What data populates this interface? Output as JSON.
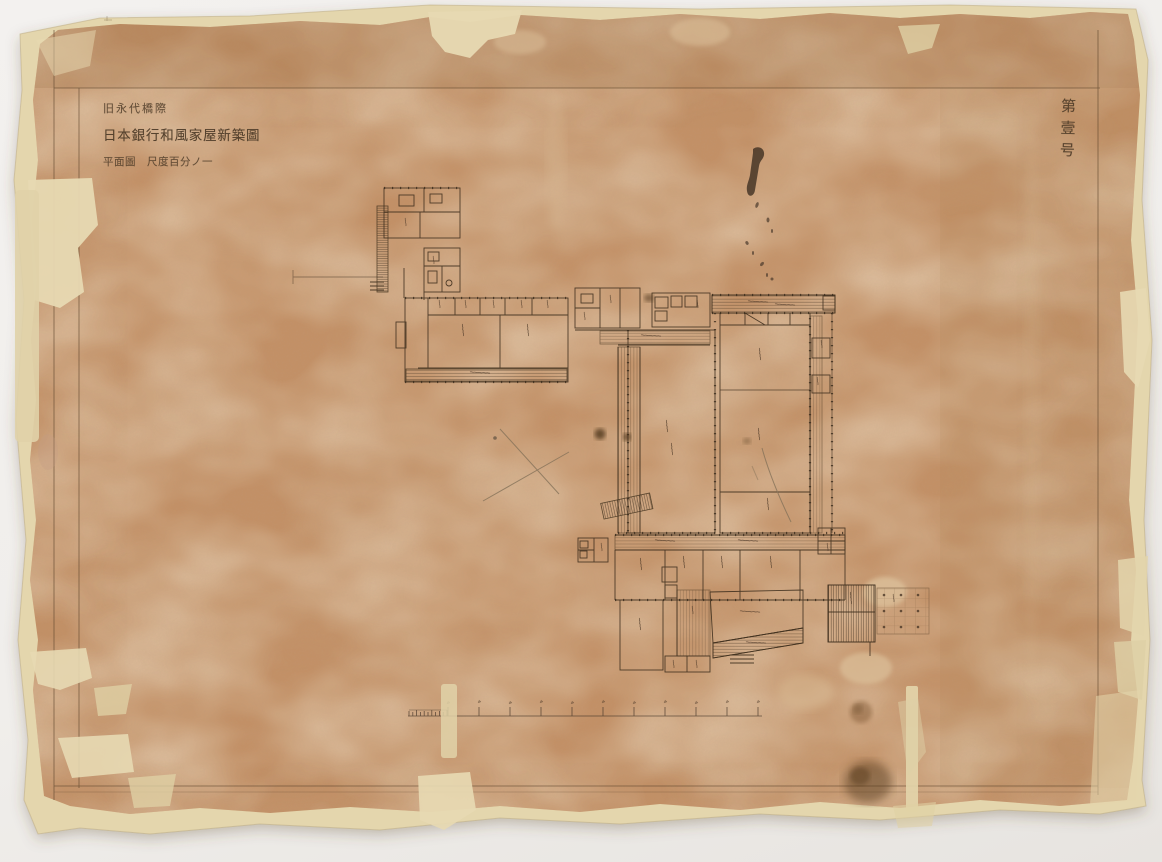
{
  "scene": {
    "backdrop_color": "#f0eeea",
    "paper_color": "#c29066",
    "backing_color": "#e4d6ad",
    "ink_color": "#4a3828",
    "stain_color": "#5a3c1e"
  },
  "title_block": {
    "line1": "旧永代橋際",
    "line2": "日本銀行和風家屋新築圖",
    "line3": "平面圖　尺度百分ノ一"
  },
  "sheet_number": "第壹号"
}
